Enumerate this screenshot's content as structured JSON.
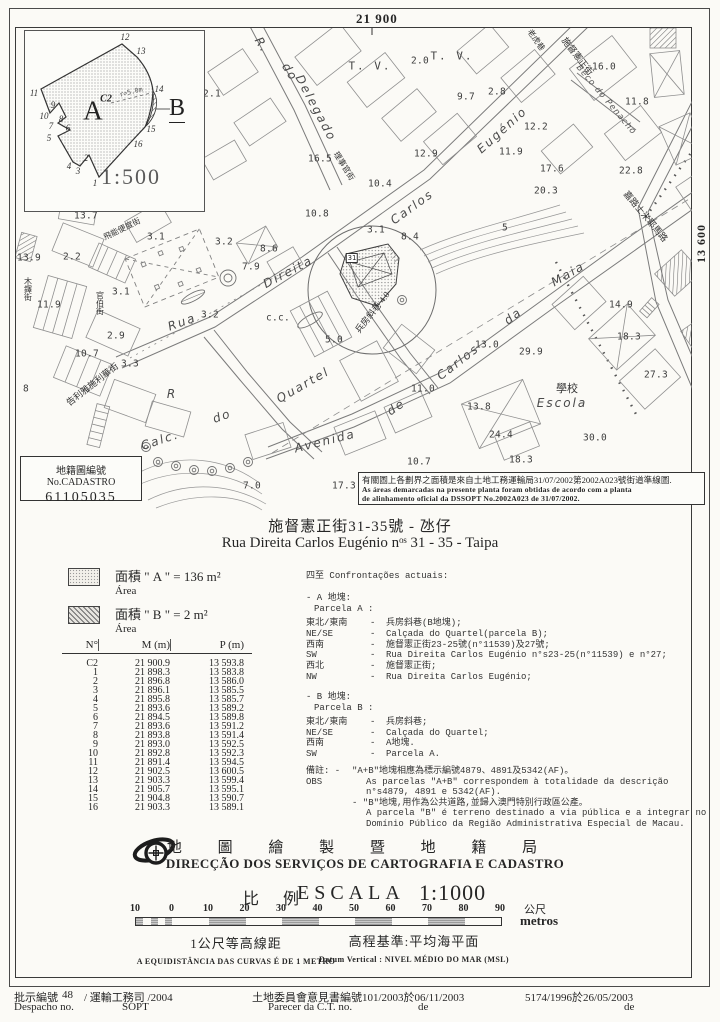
{
  "page": {
    "title_zh": "施督憲正街31-35號  - 氹仔",
    "title_pt": "Rua Direita Carlos Eugénio nᵒˢ 31 - 35  -  Taipa"
  },
  "map": {
    "coord_top": "21 900",
    "coord_right": "13 600",
    "site_number": "31",
    "inset": {
      "scale": "1:500",
      "labels": [
        {
          "t": "1",
          "x": 70,
          "y": 152,
          "c": "vtx"
        },
        {
          "t": "2",
          "x": 61,
          "y": 127,
          "c": "vtx"
        },
        {
          "t": "3",
          "x": 53,
          "y": 140,
          "c": "vtx"
        },
        {
          "t": "4",
          "x": 44,
          "y": 135,
          "c": "vtx"
        },
        {
          "t": "5",
          "x": 24,
          "y": 107,
          "c": "vtx"
        },
        {
          "t": "6",
          "x": 43,
          "y": 97,
          "c": "vtx"
        },
        {
          "t": "7",
          "x": 26,
          "y": 95,
          "c": "vtx"
        },
        {
          "t": "8",
          "x": 36,
          "y": 88,
          "c": "vtx"
        },
        {
          "t": "9",
          "x": 28,
          "y": 74,
          "c": "vtx"
        },
        {
          "t": "10",
          "x": 19,
          "y": 85,
          "c": "vtx"
        },
        {
          "t": "11",
          "x": 9,
          "y": 62,
          "c": "vtx"
        },
        {
          "t": "12",
          "x": 100,
          "y": 6,
          "c": "vtx"
        },
        {
          "t": "13",
          "x": 116,
          "y": 20,
          "c": "vtx"
        },
        {
          "t": "14",
          "x": 134,
          "y": 58,
          "c": "vtx"
        },
        {
          "t": "15",
          "x": 126,
          "y": 98,
          "c": "vtx"
        },
        {
          "t": "16",
          "x": 113,
          "y": 113,
          "c": "vtx"
        },
        {
          "t": "A",
          "x": 68,
          "y": 80,
          "c": "huge"
        },
        {
          "t": "B",
          "x": 152,
          "y": 78,
          "c": "hugeb"
        },
        {
          "t": "C2",
          "x": 81,
          "y": 68,
          "c": "c2"
        },
        {
          "t": "r=5.0m",
          "x": 106,
          "y": 61,
          "r": -14,
          "c": "rad"
        }
      ]
    },
    "cadastro_box": {
      "line1": "地籍圖編號 No.CADASTRO",
      "number": "61105035"
    },
    "note_box": {
      "zh": "有關圖上各劃界之面積是來自土地工務運輸局31/07/2002第2002A023號街道準線圖.",
      "pt1": "As áreas demarcadas na presente planta foram obtidas de acordo com a planta",
      "pt2": "de alinhamento oficial da DSSOPT No.2002A023 de 31/07/2002."
    },
    "labels": [
      {
        "t": "R.",
        "x": 262,
        "y": 45,
        "r": 58,
        "c": "s"
      },
      {
        "t": "do",
        "x": 290,
        "y": 72,
        "r": 58,
        "c": "s"
      },
      {
        "t": "Delegado",
        "x": 316,
        "y": 108,
        "r": 62,
        "c": "s"
      },
      {
        "t": "Rua",
        "x": 182,
        "y": 322,
        "r": -20,
        "c": "s"
      },
      {
        "t": "Direita",
        "x": 288,
        "y": 272,
        "r": -28,
        "c": "s"
      },
      {
        "t": "Carlos",
        "x": 412,
        "y": 207,
        "r": -36,
        "c": "s"
      },
      {
        "t": "Eugénio",
        "x": 502,
        "y": 130,
        "r": -42,
        "c": "s"
      },
      {
        "t": "Avenida",
        "x": 325,
        "y": 441,
        "r": -14,
        "c": "s"
      },
      {
        "t": "de",
        "x": 396,
        "y": 407,
        "r": -35,
        "c": "s"
      },
      {
        "t": "Carlos",
        "x": 458,
        "y": 362,
        "r": -38,
        "c": "s"
      },
      {
        "t": "da",
        "x": 513,
        "y": 316,
        "r": -38,
        "c": "s"
      },
      {
        "t": "Maia",
        "x": 568,
        "y": 274,
        "r": -30,
        "c": "s"
      },
      {
        "t": "Calc.",
        "x": 160,
        "y": 440,
        "r": -18,
        "c": "s"
      },
      {
        "t": "R",
        "x": 172,
        "y": 394,
        "c": "s"
      },
      {
        "t": "do",
        "x": 222,
        "y": 416,
        "r": -20,
        "c": "s"
      },
      {
        "t": "Quartel",
        "x": 303,
        "y": 385,
        "r": -30,
        "c": "s"
      },
      {
        "t": "Beco do Penacho",
        "x": 606,
        "y": 100,
        "r": 50,
        "c": "s8"
      },
      {
        "t": "Escola",
        "x": 562,
        "y": 403,
        "c": "s"
      },
      {
        "t": "學校",
        "x": 567,
        "y": 388,
        "c": "z",
        "fs": 11
      },
      {
        "t": "施督憲正街",
        "x": 578,
        "y": 56,
        "r": 52,
        "c": "z"
      },
      {
        "t": "老虎巷",
        "x": 536,
        "y": 40,
        "r": 55,
        "c": "z",
        "fs": 8
      },
      {
        "t": "嘉路士米耶馬路",
        "x": 646,
        "y": 216,
        "r": 50,
        "c": "z"
      },
      {
        "t": "兵房斜巷 4.0",
        "x": 372,
        "y": 312,
        "r": -52,
        "c": "z"
      },
      {
        "t": "理事官街",
        "x": 344,
        "y": 166,
        "r": 58,
        "c": "z",
        "fs": 8
      },
      {
        "t": "飛能便度街",
        "x": 122,
        "y": 229,
        "r": -26,
        "c": "z",
        "fs": 8
      },
      {
        "t": "木鐸街",
        "x": 28,
        "y": 289,
        "c": "zv"
      },
      {
        "t": "官伯街",
        "x": 100,
        "y": 303,
        "c": "zv"
      },
      {
        "t": "告利雅施利華街",
        "x": 92,
        "y": 384,
        "r": -38,
        "c": "z"
      },
      {
        "t": "T. V.",
        "x": 370,
        "y": 66,
        "c": "tv"
      },
      {
        "t": "T. V.",
        "x": 452,
        "y": 56,
        "c": "tv"
      },
      {
        "t": "31",
        "x": 352,
        "y": 258,
        "c": "n31"
      },
      {
        "t": "2.1",
        "x": 212,
        "y": 94,
        "c": "n"
      },
      {
        "t": "2.0",
        "x": 420,
        "y": 61,
        "c": "n"
      },
      {
        "t": "9.7",
        "x": 466,
        "y": 97,
        "c": "n"
      },
      {
        "t": "2.8",
        "x": 497,
        "y": 92,
        "c": "n"
      },
      {
        "t": "16.0",
        "x": 604,
        "y": 67,
        "c": "n"
      },
      {
        "t": "11.8",
        "x": 637,
        "y": 102,
        "c": "n"
      },
      {
        "t": "12.9",
        "x": 426,
        "y": 154,
        "c": "n"
      },
      {
        "t": "12.2",
        "x": 536,
        "y": 127,
        "c": "n"
      },
      {
        "t": "11.9",
        "x": 511,
        "y": 152,
        "c": "n"
      },
      {
        "t": "17.6",
        "x": 552,
        "y": 169,
        "c": "n"
      },
      {
        "t": "22.8",
        "x": 631,
        "y": 171,
        "c": "n"
      },
      {
        "t": "20.3",
        "x": 546,
        "y": 191,
        "c": "n"
      },
      {
        "t": "10.4",
        "x": 380,
        "y": 184,
        "c": "n"
      },
      {
        "t": "16.5",
        "x": 320,
        "y": 159,
        "c": "n"
      },
      {
        "t": "10.8",
        "x": 317,
        "y": 214,
        "c": "n"
      },
      {
        "t": "13.7",
        "x": 86,
        "y": 216,
        "c": "n"
      },
      {
        "t": "2.2",
        "x": 72,
        "y": 257,
        "c": "n"
      },
      {
        "t": "13.9",
        "x": 29,
        "y": 258,
        "c": "n"
      },
      {
        "t": "11.9",
        "x": 49,
        "y": 305,
        "c": "n"
      },
      {
        "t": "8",
        "x": 26,
        "y": 389,
        "c": "n"
      },
      {
        "t": "10.7",
        "x": 87,
        "y": 354,
        "c": "n"
      },
      {
        "t": "2.9",
        "x": 116,
        "y": 336,
        "c": "n"
      },
      {
        "t": "3.3",
        "x": 130,
        "y": 364,
        "c": "n"
      },
      {
        "t": "3.1",
        "x": 156,
        "y": 237,
        "c": "n"
      },
      {
        "t": "3.1",
        "x": 121,
        "y": 292,
        "c": "n"
      },
      {
        "t": "3.2",
        "x": 224,
        "y": 242,
        "c": "n"
      },
      {
        "t": "3.2",
        "x": 210,
        "y": 315,
        "c": "n"
      },
      {
        "t": "8.6",
        "x": 269,
        "y": 249,
        "c": "n"
      },
      {
        "t": "7.9",
        "x": 251,
        "y": 267,
        "c": "n"
      },
      {
        "t": "8.4",
        "x": 410,
        "y": 237,
        "c": "n"
      },
      {
        "t": "3.1",
        "x": 376,
        "y": 230,
        "c": "n"
      },
      {
        "t": "11.0",
        "x": 423,
        "y": 389,
        "c": "n"
      },
      {
        "t": "13.0",
        "x": 487,
        "y": 345,
        "c": "n"
      },
      {
        "t": "29.9",
        "x": 531,
        "y": 352,
        "c": "n"
      },
      {
        "t": "14.9",
        "x": 621,
        "y": 305,
        "c": "n"
      },
      {
        "t": "18.3",
        "x": 629,
        "y": 337,
        "c": "n"
      },
      {
        "t": "27.3",
        "x": 656,
        "y": 375,
        "c": "n"
      },
      {
        "t": "13.8",
        "x": 479,
        "y": 407,
        "c": "n"
      },
      {
        "t": "24.4",
        "x": 501,
        "y": 435,
        "c": "n"
      },
      {
        "t": "18.3",
        "x": 521,
        "y": 460,
        "c": "n"
      },
      {
        "t": "30.0",
        "x": 595,
        "y": 438,
        "c": "n"
      },
      {
        "t": "10.7",
        "x": 419,
        "y": 462,
        "c": "n"
      },
      {
        "t": "7.0",
        "x": 252,
        "y": 486,
        "c": "n"
      },
      {
        "t": "17.3",
        "x": 344,
        "y": 486,
        "c": "n"
      },
      {
        "t": "5",
        "x": 505,
        "y": 228,
        "c": "n"
      },
      {
        "t": "5.0",
        "x": 334,
        "y": 340,
        "c": "n"
      },
      {
        "t": "c.c.",
        "x": 278,
        "y": 318,
        "c": "n"
      }
    ]
  },
  "legend": {
    "a_label": "面積 \" A \" =  136 m²",
    "a_sub": "Área",
    "b_label": "面積 \" B \" =   2  m²",
    "b_sub": "Área"
  },
  "table": {
    "headers": [
      "N°",
      "M (m)",
      "P (m)"
    ],
    "rows": [
      [
        "C2",
        "21 900.9",
        "13 593.8"
      ],
      [
        "1",
        "21 898.3",
        "13 583.8"
      ],
      [
        "2",
        "21 896.8",
        "13 586.0"
      ],
      [
        "3",
        "21 896.1",
        "13 585.5"
      ],
      [
        "4",
        "21 895.8",
        "13 585.7"
      ],
      [
        "5",
        "21 893.6",
        "13 589.2"
      ],
      [
        "6",
        "21 894.5",
        "13 589.8"
      ],
      [
        "7",
        "21 893.6",
        "13 591.2"
      ],
      [
        "8",
        "21 893.8",
        "13 591.4"
      ],
      [
        "9",
        "21 893.0",
        "13 592.5"
      ],
      [
        "10",
        "21 892.8",
        "13 592.3"
      ],
      [
        "11",
        "21 891.4",
        "13 594.5"
      ],
      [
        "12",
        "21 902.5",
        "13 600.5"
      ],
      [
        "13",
        "21 903.3",
        "13 599.4"
      ],
      [
        "14",
        "21 905.7",
        "13 595.1"
      ],
      [
        "15",
        "21 904.8",
        "13 590.7"
      ],
      [
        "16",
        "21 903.3",
        "13 589.1"
      ]
    ]
  },
  "confrontations": {
    "heading_zh": "四至",
    "heading_pt": "Confrontações actuais:",
    "parcel_a": {
      "zh": "- A 地塊:",
      "pt": "Parcela A :",
      "items": [
        {
          "dir": "東北/東南",
          "text": "兵房斜巷(B地塊);"
        },
        {
          "dir": "NE/SE",
          "text": "Calçada do Quartel(parcela B);"
        },
        {
          "dir": "西南",
          "text": "施督憲正街23-25號(n°11539)及27號;"
        },
        {
          "dir": "SW",
          "text": "Rua Direita Carlos Eugénio n°s23-25(n°11539) e n°27;"
        },
        {
          "dir": "西北",
          "text": "施督憲正街;"
        },
        {
          "dir": "NW",
          "text": "Rua Direita Carlos Eugénio;"
        }
      ]
    },
    "parcel_b": {
      "zh": "- B 地塊:",
      "pt": "Parcela B :",
      "items": [
        {
          "dir": "東北/東南",
          "text": "兵房斜巷;"
        },
        {
          "dir": "NE/SE",
          "text": "Calçada do Quartel;"
        },
        {
          "dir": "西南",
          "text": "A地塊."
        },
        {
          "dir": "SW",
          "text": "Parcela A."
        }
      ]
    },
    "obs_label_zh": "備註: -",
    "obs_label_pt": "OBS",
    "obs": [
      {
        "t": "\"A+B\"地塊相應為標示編號4879、4891及5342(AF)。",
        "i": 0
      },
      {
        "t": "As parcelas \"A+B\" correspondem à totalidade da descrição",
        "i": 1
      },
      {
        "t": "n°s4879, 4891 e 5342(AF).",
        "i": 1
      },
      {
        "t": "- \"B\"地塊,用作為公共道路,並歸入澳門特別行政區公產。",
        "i": 0
      },
      {
        "t": "A parcela \"B\" é terreno destinado a via pública e a integrar no",
        "i": 1
      },
      {
        "t": "Domínio Público da Região Administrativa Especial de Macau.",
        "i": 1
      }
    ]
  },
  "agency": {
    "name_zh": "地 圖 繪 製 暨 地 籍 局",
    "name_pt": "DIRECÇÃO DOS SERVIÇOS DE CARTOGRAFIA E CADASTRO",
    "scale_zh": "比 例",
    "scale_pt": "ESCALA",
    "scale_value": "1:1000"
  },
  "scalebar": {
    "ticks": [
      "10",
      "0",
      "10",
      "20",
      "30",
      "40",
      "50",
      "60",
      "70",
      "80",
      "90"
    ],
    "unit_zh": "公尺",
    "unit_pt": "metros",
    "contour_zh": "1公尺等高線距",
    "contour_pt": "A EQUIDISTÂNCIA DAS CURVAS É DE 1 METRO",
    "datum_zh": "高程基準:平均海平面",
    "datum_pt": "Datum Vertical : NIVEL MÉDIO DO MAR (MSL)"
  },
  "footer": {
    "despacho_zh": "批示編號",
    "despacho_no": "48",
    "despacho_mid": "/ 運輸工務司 /2004",
    "despacho_pt": "Despacho no.",
    "despacho_sopt": "SOPT",
    "parecer_zh": "土地委員會意見書編號101/2003於06/11/2003",
    "parecer_pt": "Parecer da C.T. no.",
    "parecer_de": "de",
    "ref_right": "5174/1996於26/05/2003",
    "ref_right_de": "de"
  }
}
